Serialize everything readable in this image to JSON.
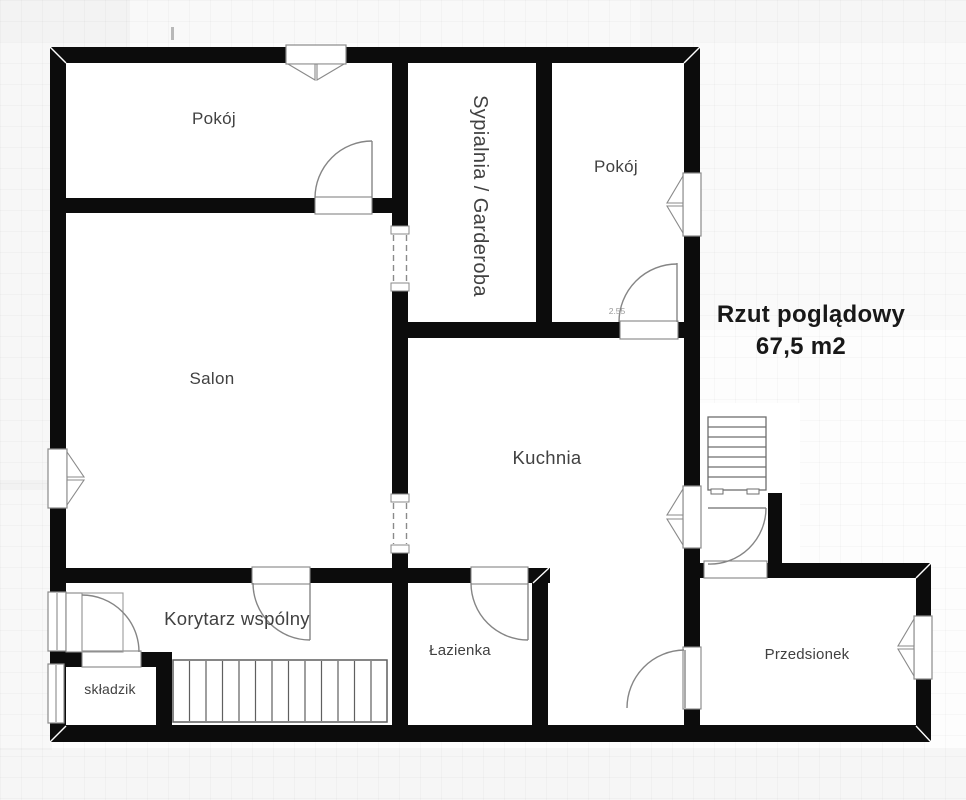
{
  "title": {
    "line1": "Rzut poglądowy",
    "line2": "67,5 m2"
  },
  "rooms": {
    "pokoj_tl": "Pokój",
    "sypialnia": "Sypialnia / Garderoba",
    "pokoj_tr": "Pokój",
    "salon": "Salon",
    "kuchnia": "Kuchnia",
    "korytarz": "Korytarz wspólny",
    "lazienka": "Łazienka",
    "skladzik": "składzik",
    "przedsionek": "Przedsionek"
  },
  "dimensions": {
    "pokoj_tr_door_width": "2.55"
  },
  "colors": {
    "wall": "#0c0c0c",
    "symbol_line": "#8a8a8a",
    "label": "#414141",
    "title": "#181818",
    "background": "#fdfdfd"
  }
}
